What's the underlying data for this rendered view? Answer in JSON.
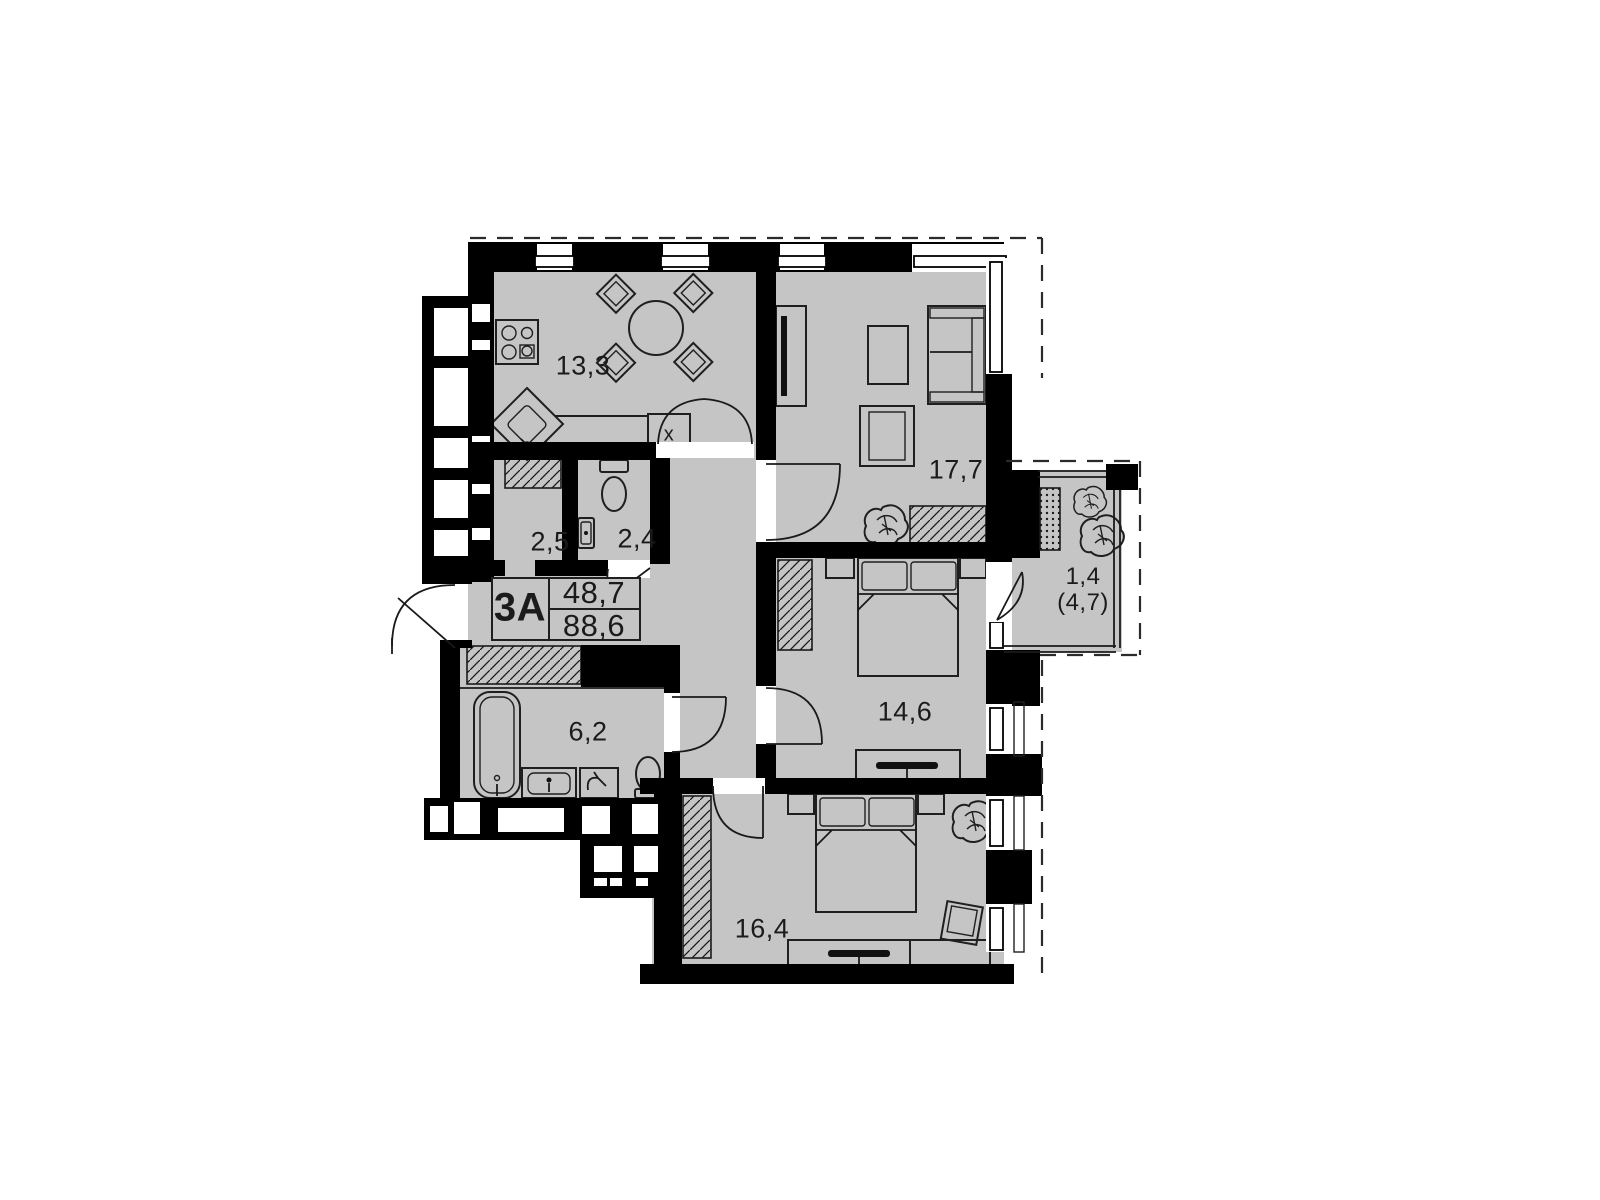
{
  "plan": {
    "unit": {
      "code": "3A",
      "area_living": "48,7",
      "area_total": "88,6"
    },
    "rooms": [
      {
        "id": "kitchen",
        "area": "13,3"
      },
      {
        "id": "living-room",
        "area": "17,7"
      },
      {
        "id": "closet",
        "area": "2,5"
      },
      {
        "id": "wc",
        "area": "2,4"
      },
      {
        "id": "bedroom-1",
        "area": "14,6"
      },
      {
        "id": "bathroom",
        "area": "6,2"
      },
      {
        "id": "bedroom-2",
        "area": "16,4"
      },
      {
        "id": "balcony",
        "area": "1,4",
        "area_secondary": "(4,7)"
      }
    ],
    "markers": {
      "kitchen_unit": "x"
    },
    "colors": {
      "floor": "#c5c5c5",
      "wall": "#000000",
      "line": "#1f1f1f",
      "background": "#ffffff"
    }
  }
}
